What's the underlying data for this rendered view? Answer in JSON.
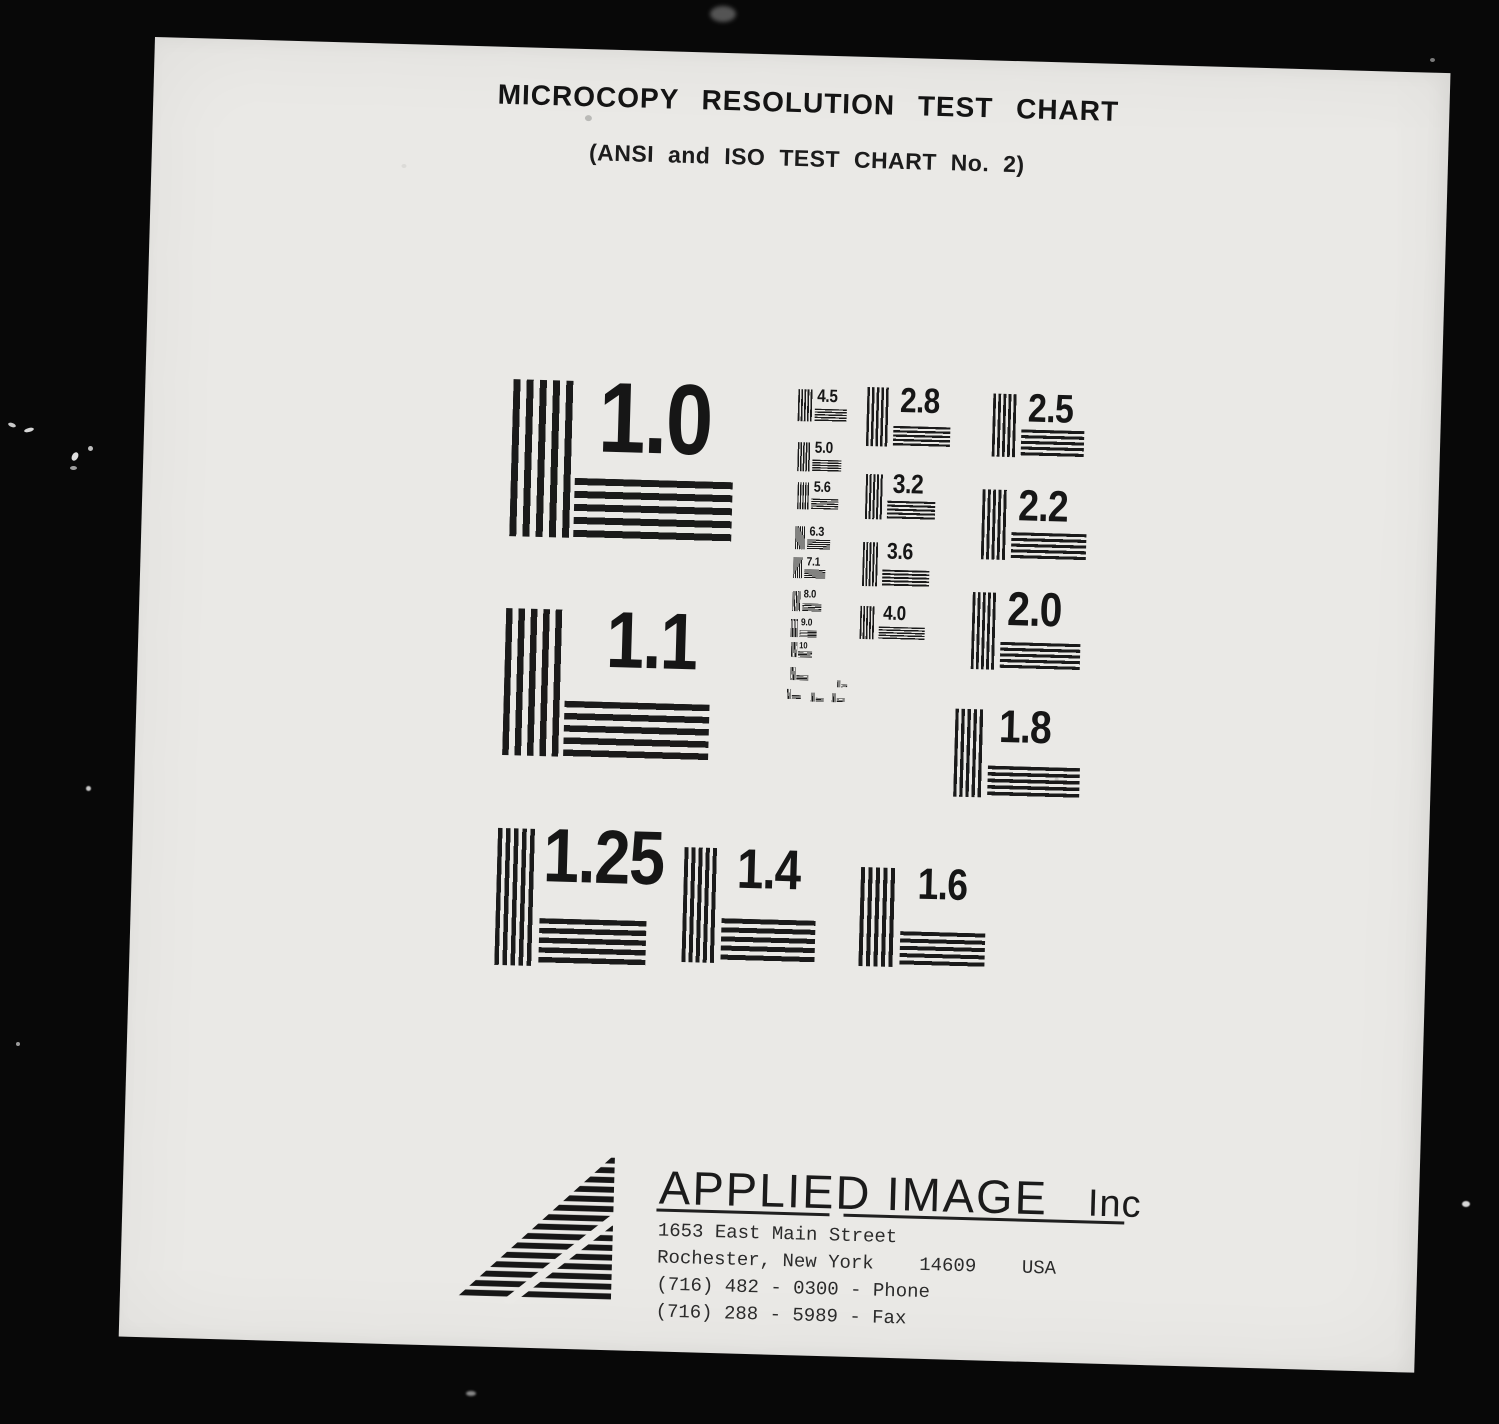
{
  "page": {
    "title": "MICROCOPY RESOLUTION TEST CHART",
    "subtitle": "(ANSI and ISO TEST CHART No. 2)"
  },
  "targets": [
    {
      "label": "1.0"
    },
    {
      "label": "1.1"
    },
    {
      "label": "1.25"
    },
    {
      "label": "1.4"
    },
    {
      "label": "1.6"
    },
    {
      "label": "1.8"
    },
    {
      "label": "2.0"
    },
    {
      "label": "2.2"
    },
    {
      "label": "2.5"
    },
    {
      "label": "2.8"
    },
    {
      "label": "3.2"
    },
    {
      "label": "3.6"
    },
    {
      "label": "4.0"
    },
    {
      "label": "4.5"
    },
    {
      "label": "5.0"
    },
    {
      "label": "5.6"
    },
    {
      "label": "6.3"
    },
    {
      "label": "7.1"
    },
    {
      "label": "8.0"
    },
    {
      "label": "9.0"
    },
    {
      "label": "10"
    }
  ],
  "footer": {
    "company": "APPLIED IMAGE",
    "company_suffix": "Inc",
    "address_line1": "1653 East Main Street",
    "address_line2": "Rochester, New York    14609    USA",
    "address_line3": "(716) 482 - 0300 - Phone",
    "address_line4": "(716) 288 - 5989 - Fax"
  },
  "colors": {
    "paper": "#eae9e6",
    "scanner_background": "#080808",
    "ink": "#1a1a1a"
  }
}
